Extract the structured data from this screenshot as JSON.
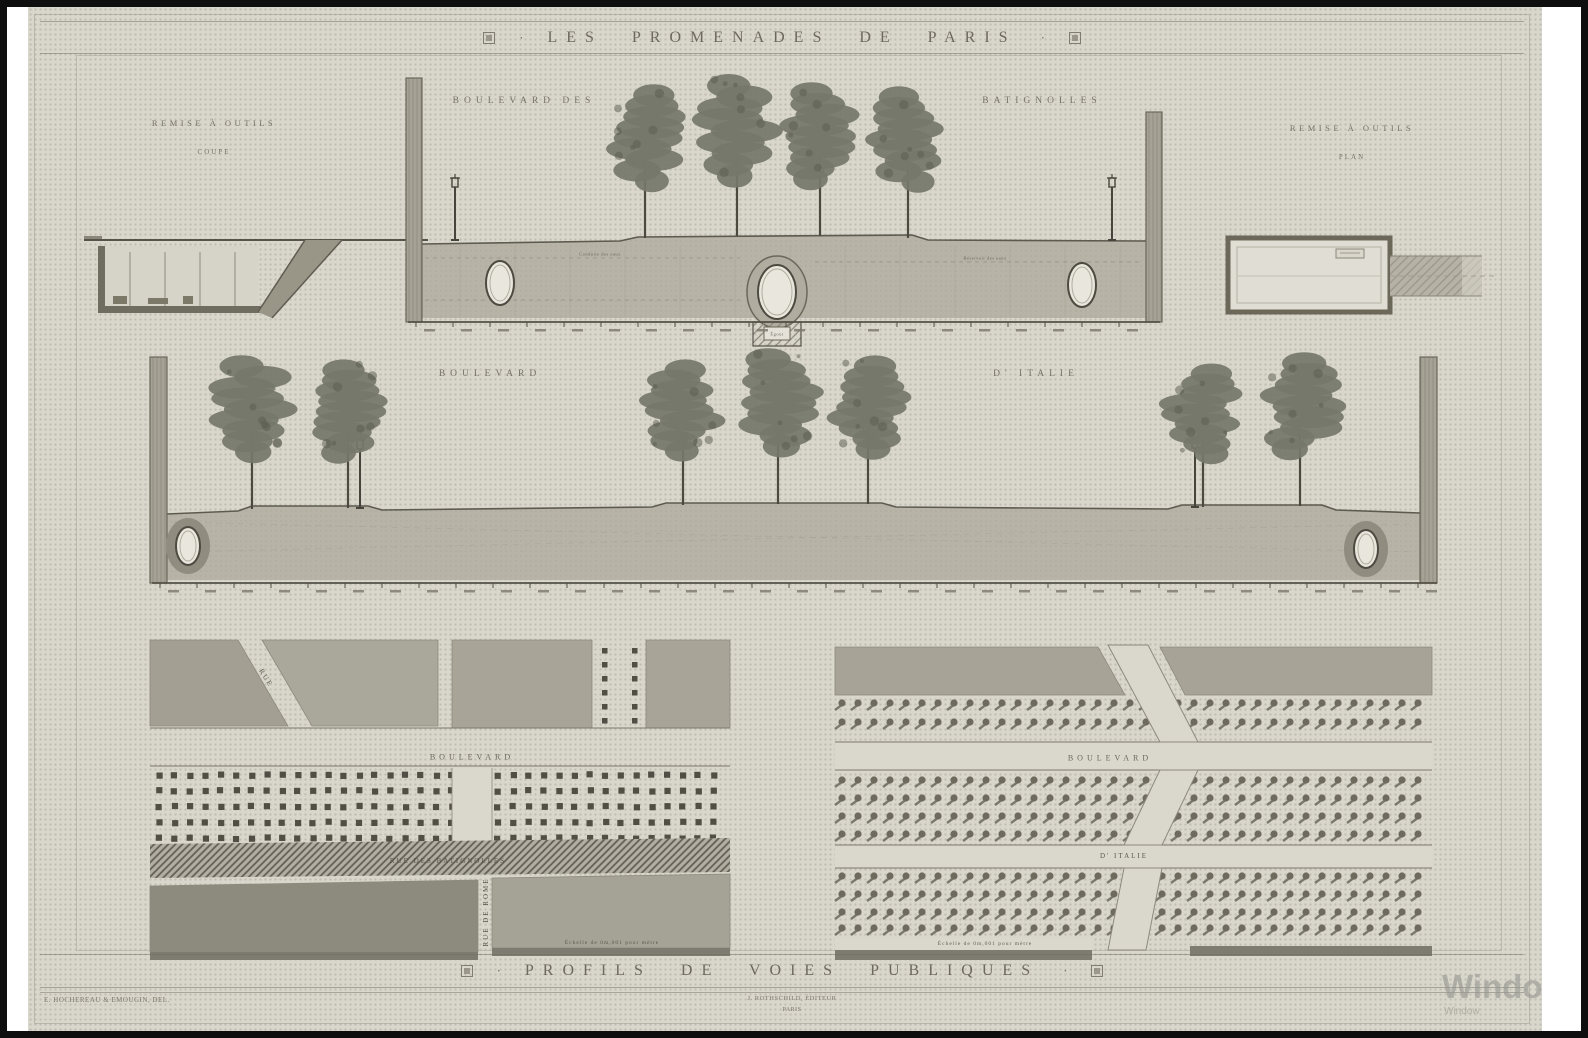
{
  "plate": {
    "title": "LES PROMENADES DE PARIS",
    "footer_title": "PROFILS DE VOIES PUBLIQUES",
    "title_separator": "·"
  },
  "colors": {
    "paper": "#d9d6cb",
    "ink": "#4f4c43",
    "faded_ink": "#6e6a5d",
    "ground_fill": "#b7b4a7",
    "block_fill": "#a5a296",
    "dark_block_fill": "#8d8a7e",
    "tree_canopy": "#75776a",
    "frame_black": "#0e0e0e"
  },
  "sections": {
    "toolshed_coupe": {
      "title": "REMISE À OUTILS",
      "subtitle": "COUPE"
    },
    "toolshed_plan": {
      "title": "REMISE À OUTILS",
      "subtitle": "PLAN"
    },
    "profile_batignolles": {
      "label_left": "BOULEVARD DES",
      "label_right": "BATIGNOLLES",
      "annotations": [
        "Conduite des eaux",
        "Réservoir des eaux",
        "Égout"
      ]
    },
    "profile_italie": {
      "label_left": "BOULEVARD",
      "label_right": "D' ITALIE"
    },
    "plan_batignolles": {
      "boulevard_label": "BOULEVARD",
      "street_label": "RUE DES BATIGNOLLES",
      "side_street_label": "RUE DE ROME",
      "diagonal_street_label": "RUE",
      "caption": "Échelle de 0m,001 pour mètre"
    },
    "plan_italie": {
      "boulevard_label": "BOULEVARD",
      "street_label": "D' ITALIE",
      "caption": "Échelle de 0m,001 pour mètre"
    }
  },
  "credits": {
    "left": "E. HOCHEREAU & EMOUGIN, DEL.",
    "center_line1": "J. ROTHSCHILD, ÉDITEUR",
    "center_line2": "PARIS"
  },
  "watermark": {
    "line1": "Windo",
    "line2": "Window"
  }
}
